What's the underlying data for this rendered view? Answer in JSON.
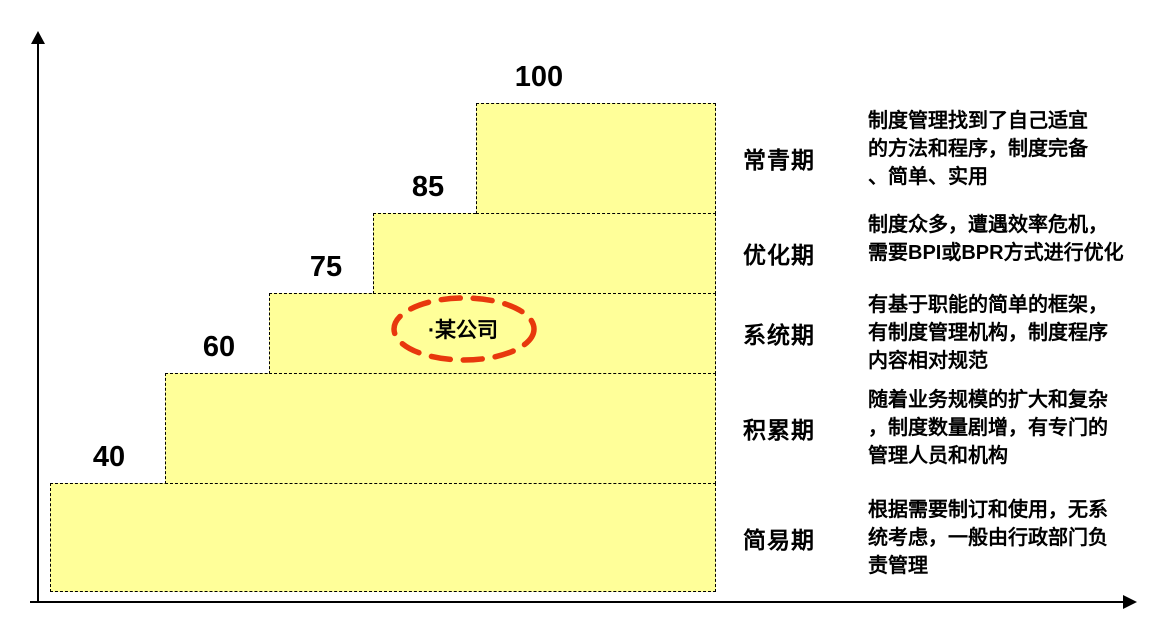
{
  "stages": [
    {
      "score": "40",
      "name": "简易期",
      "desc": "根据需要制订和使用，无系\n统考虑，一般由行政部门负\n责管理"
    },
    {
      "score": "60",
      "name": "积累期",
      "desc": "随着业务规模的扩大和复杂\n，制度数量剧增，有专门的\n管理人员和机构"
    },
    {
      "score": "75",
      "name": "系统期",
      "desc": "有基于职能的简单的框架，\n有制度管理机构，制度程序\n内容相对规范"
    },
    {
      "score": "85",
      "name": "优化期",
      "desc": "制度众多，遭遇效率危机，\n需要BPI或BPR方式进行优化"
    },
    {
      "score": "100",
      "name": "常青期",
      "desc": "制度管理找到了自己适宜\n的方法和程序，制度完备\n、简单、实用"
    }
  ],
  "annotation": {
    "label": "·某公司"
  },
  "colors": {
    "step_fill": "#FFFF99",
    "step_border": "#000000",
    "highlight_red": "#E8380D",
    "text": "#000000",
    "background": "#FFFFFF"
  },
  "chart_data": {
    "type": "bar",
    "title": "",
    "categories": [
      "简易期",
      "积累期",
      "系统期",
      "优化期",
      "常青期"
    ],
    "values": [
      40,
      60,
      75,
      85,
      100
    ],
    "xlabel": "",
    "ylabel": "",
    "ylim": [
      0,
      100
    ],
    "grid": false,
    "legend_position": "none",
    "annotations": [
      "·某公司 marked on 系统期 step"
    ]
  }
}
